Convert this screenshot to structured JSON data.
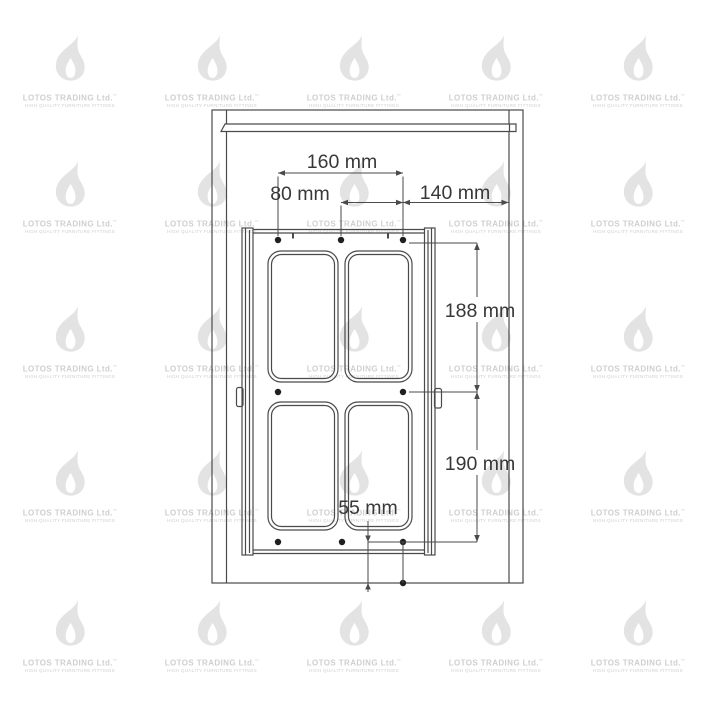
{
  "watermark": {
    "brand": "LOTOS TRADING Ltd.",
    "mark": "™",
    "tagline": "HIGH QUALITY FURNITURE FITTINGS",
    "flame_color": "#e3e3e3",
    "text_color": "#cfcfcf",
    "col_centers": [
      70,
      212,
      354,
      496,
      638
    ],
    "row_centers": [
      62,
      188,
      333,
      477,
      627
    ]
  },
  "drawing": {
    "description": "Front view installation drawing of a door-mounted four-basket rack inside a cabinet with drilling dimensions",
    "unit": "mm",
    "line_color": "#4a4a4a",
    "text_color": "#383838",
    "dimensions": {
      "top_span": {
        "label": "160 mm",
        "value": 160,
        "orientation": "horizontal"
      },
      "top_left": {
        "label": "80 mm",
        "value": 80,
        "orientation": "horizontal"
      },
      "top_right": {
        "label": "140 mm",
        "value": 140,
        "orientation": "horizontal"
      },
      "upper_height": {
        "label": "188 mm",
        "value": 188,
        "orientation": "vertical"
      },
      "lower_height": {
        "label": "190 mm",
        "value": 190,
        "orientation": "vertical"
      },
      "bottom_offset": {
        "label": "55 mm",
        "value": 55,
        "orientation": "vertical"
      }
    }
  }
}
